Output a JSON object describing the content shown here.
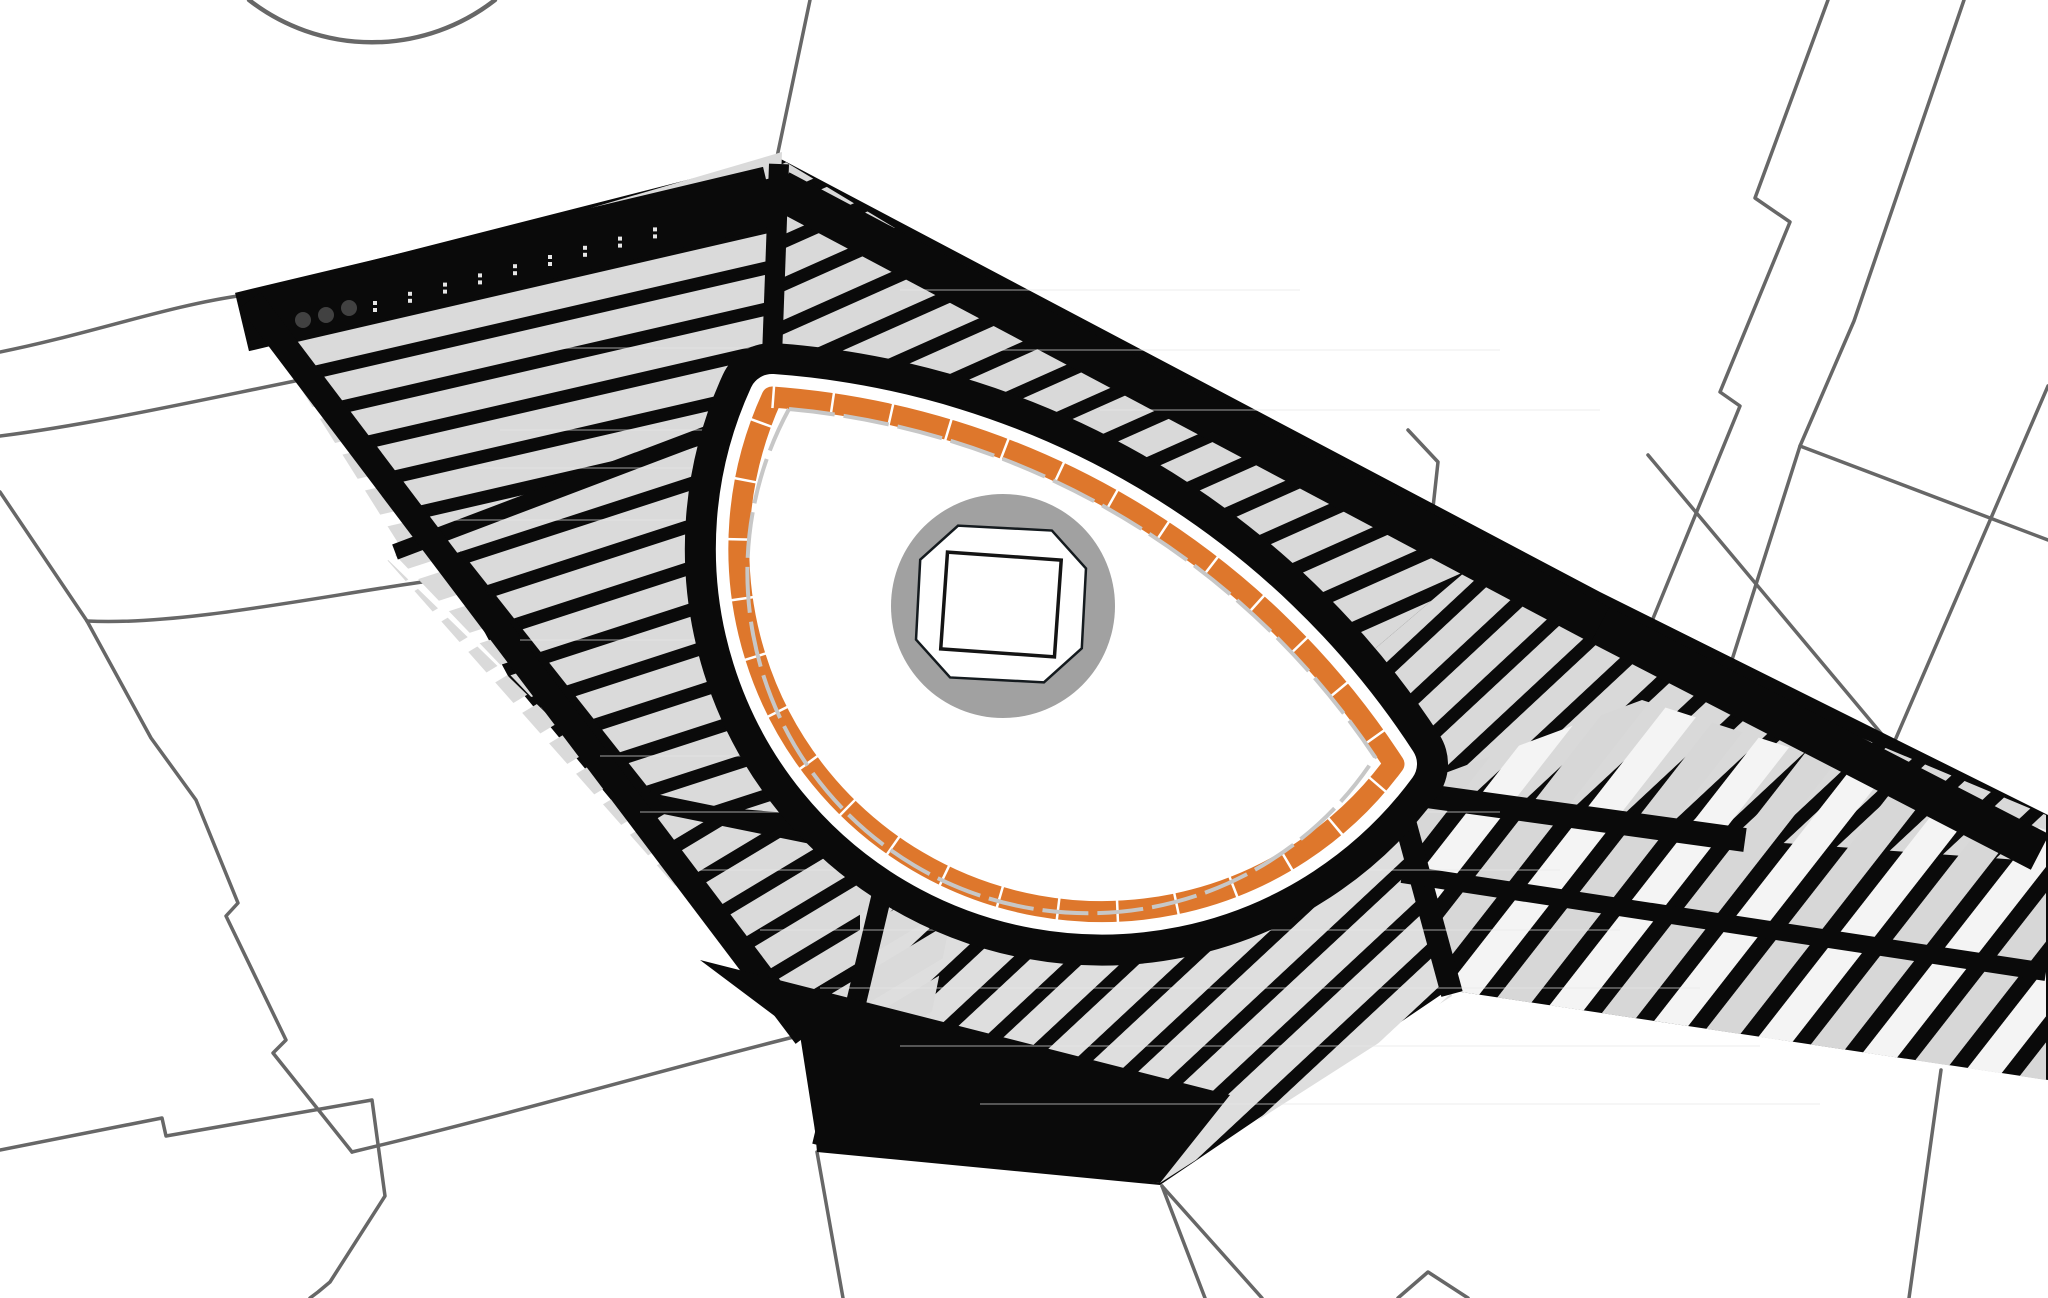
{
  "canvas": {
    "width": 2048,
    "height": 1298,
    "background": "#ffffff"
  },
  "palette": {
    "site_black": "#0a0a0a",
    "bar_gray": "#dadada",
    "bar_gray_2": "#d9d9d9",
    "bar_gray_3": "#dedede",
    "bar_light": "#f4f4f4",
    "bar_mid": "#d7d7d7",
    "parcel_line": "#676767",
    "plaza_ring_orange": "#de772c",
    "plaza_halo_white": "#ffffff",
    "plaza_inner_dash": "#c7c7c7",
    "center_circle_gray": "#a1a1a1",
    "building_outline": "#141414",
    "building_fill": "#ffffff",
    "dot_dark": "#414141",
    "dot_gray": "#6a6a6a",
    "tick_white": "#e6e6e6",
    "streak": "#e8e8e8"
  },
  "parcels": {
    "stroke": "#676767",
    "width": 3.5,
    "arc_width": 4.5,
    "paths": [
      "M 249,0 A 200,200 0 0 0 495,0",
      "M 0,352 C 90,334 170,305 245,295",
      "M 0,436 C 95,424 210,398 310,378",
      "M 0,492 L 87,621",
      "M 87,621 C 180,626 320,596 436,580",
      "M 87,621 L 151,738 L 196,800 L 238,903 L 226,916 L 286,1040 L 273,1053 L 352,1152",
      "M 352,1152 C 520,1112 690,1062 806,1034",
      "M 0,1150 L 162,1118 L 166,1136 L 372,1100 L 385,1196 L 330,1282 L 318,1292 L 310,1298",
      "M 777,157 L 810,0",
      "M 1828,0 L 1755,198 L 1790,222 L 1720,392 L 1740,406 L 1652,621",
      "M 1964,0 L 1854,321 L 1800,446 L 1731,663",
      "M 1800,446 L 2048,540",
      "M 1648,455 L 1890,744",
      "M 2048,386 L 1893,745",
      "M 1408,430 L 1438,462 L 1430,535",
      "M 1941,1070 L 1909,1298",
      "M 1162,1186 L 1262,1298",
      "M 1162,1186 L 1205,1298",
      "M 817,1152 L 843,1298",
      "M 1398,1298 L 1428,1272 L 1468,1298"
    ]
  },
  "site": {
    "fill": "#0a0a0a",
    "outline": "248,292 777,157 1600,592 2048,815 2048,1080 1448,990 1160,1185 817,1152 806,1034 508,676 452,571 415,528 372,447 322,381"
  },
  "sectors": [
    {
      "name": "nw-band",
      "points": "250,308 782,152 772,418 400,546",
      "angle": -13,
      "period": 40,
      "bar": 27,
      "colors": [
        "#dadada"
      ]
    },
    {
      "name": "north",
      "points": "779,158 1465,572 1262,745 992,508 768,410",
      "angle": -24,
      "period": 39,
      "bar": 26,
      "colors": [
        "#d9d9d9"
      ]
    },
    {
      "name": "northeast",
      "points": "1465,572 2046,815 2046,862 1742,840 1394,790 1262,745",
      "angle": -43,
      "period": 39,
      "bar": 26,
      "colors": [
        "#d9d9d9"
      ]
    },
    {
      "name": "east",
      "points": "1394,792 1642,700 2046,830 2046,1080 1448,990",
      "angle": -52,
      "period": 46,
      "bar": 30,
      "colors": [
        "#f4f4f4",
        "#d7d7d7"
      ]
    },
    {
      "name": "south",
      "points": "860,832 1398,770 1452,996 1160,1183 860,1145",
      "angle": -43,
      "period": 39,
      "bar": 26,
      "colors": [
        "#dedede"
      ]
    },
    {
      "name": "west",
      "points": "395,555 775,408 1010,575 935,825 630,800",
      "angle": -18,
      "period": 40,
      "bar": 27,
      "colors": [
        "#dadada"
      ]
    },
    {
      "name": "southwest",
      "points": "380,552 648,812 965,848 905,1145 806,1034",
      "angle": -31,
      "period": 40,
      "bar": 27,
      "colors": [
        "#dadada"
      ]
    }
  ],
  "aisles": {
    "color": "#0a0a0a",
    "lines": [
      {
        "x1": 242,
        "y1": 322,
        "x2": 770,
        "y2": 196,
        "w": 60
      },
      {
        "x1": 780,
        "y1": 190,
        "x2": 1600,
        "y2": 625,
        "w": 40
      },
      {
        "x1": 1600,
        "y1": 625,
        "x2": 2040,
        "y2": 852,
        "w": 40
      },
      {
        "x1": 779,
        "y1": 164,
        "x2": 770,
        "y2": 412,
        "w": 20
      },
      {
        "x1": 770,
        "y1": 410,
        "x2": 395,
        "y2": 552,
        "w": 16
      },
      {
        "x1": 450,
        "y1": 560,
        "x2": 640,
        "y2": 800,
        "w": 28
      },
      {
        "x1": 640,
        "y1": 800,
        "x2": 895,
        "y2": 852,
        "w": 18
      },
      {
        "x1": 890,
        "y1": 860,
        "x2": 822,
        "y2": 1146,
        "w": 20
      },
      {
        "x1": 1396,
        "y1": 788,
        "x2": 1452,
        "y2": 994,
        "w": 22
      },
      {
        "x1": 1398,
        "y1": 792,
        "x2": 1745,
        "y2": 840,
        "w": 24
      },
      {
        "x1": 1402,
        "y1": 874,
        "x2": 2046,
        "y2": 972,
        "w": 18
      },
      {
        "x1": 250,
        "y1": 300,
        "x2": 806,
        "y2": 1036,
        "w": 26
      }
    ],
    "polys": [
      "700,960 1230,1095 1160,1183 818,1150 800,1035"
    ]
  },
  "streaks": {
    "color": "#e8e8e8",
    "width": 1.5,
    "opacity": 0.45,
    "segments": [
      [
        900,
        290,
        1300,
        290
      ],
      [
        1000,
        350,
        1500,
        350
      ],
      [
        560,
        348,
        775,
        348
      ],
      [
        500,
        430,
        770,
        430
      ],
      [
        470,
        468,
        1080,
        468
      ],
      [
        455,
        520,
        1090,
        520
      ],
      [
        1100,
        410,
        1600,
        410
      ],
      [
        520,
        640,
        1150,
        640
      ],
      [
        600,
        756,
        860,
        756
      ],
      [
        640,
        812,
        1500,
        812
      ],
      [
        700,
        870,
        1560,
        870
      ],
      [
        760,
        930,
        1620,
        930
      ],
      [
        820,
        988,
        1700,
        988
      ],
      [
        900,
        1046,
        1760,
        1046
      ],
      [
        980,
        1104,
        1820,
        1104
      ]
    ]
  },
  "markers": {
    "band_dots": {
      "color": "#414141",
      "items": [
        {
          "x": 303,
          "y": 320,
          "r": 8
        },
        {
          "x": 326,
          "y": 315,
          "r": 8
        },
        {
          "x": 349,
          "y": 308,
          "r": 8
        }
      ]
    },
    "area_dots": {
      "color": "#6a6a6a",
      "items": [
        {
          "x": 757,
          "y": 375,
          "r": 7
        },
        {
          "x": 1421,
          "y": 768,
          "r": 7
        }
      ]
    },
    "ticks": {
      "color": "#e6e6e6",
      "x0": 373,
      "y0": 301,
      "dx": 35,
      "dy": -9.2,
      "count": 9,
      "size": 4,
      "gap": 7
    }
  },
  "plaza": {
    "eye_path": "M 772,397 A 812,812 0 0 1 1394,764 A 363,363 0 0 1 772,397 Z",
    "inner_path": "M 789,409 A 790,790 0 0 1 1375,757 A 341,341 0 0 1 789,409",
    "ring_black_w": 108,
    "halo_w": 46,
    "orange_w": 21,
    "orange_color": "#de772c",
    "orange_seg_dash": "2.5 57",
    "inner_dash": "46 9",
    "inner_w": 4,
    "inner_color": "#c7c7c7",
    "circle": {
      "cx": 1003,
      "cy": 606,
      "r": 112,
      "fill": "#a1a1a1"
    },
    "octagon": {
      "points": "918,564 954,528 1048,528 1084,564 1084,644 1048,680 954,680 918,644",
      "rotate": "3 1001 604",
      "fill": "#ffffff",
      "stroke": "#141a1e",
      "stroke_w": 2.5
    },
    "square": {
      "x": 944,
      "y": 556,
      "w": 114,
      "h": 97,
      "rotate": "4 1001 604",
      "fill": "#ffffff",
      "stroke": "#141414",
      "stroke_w": 3.5
    }
  }
}
